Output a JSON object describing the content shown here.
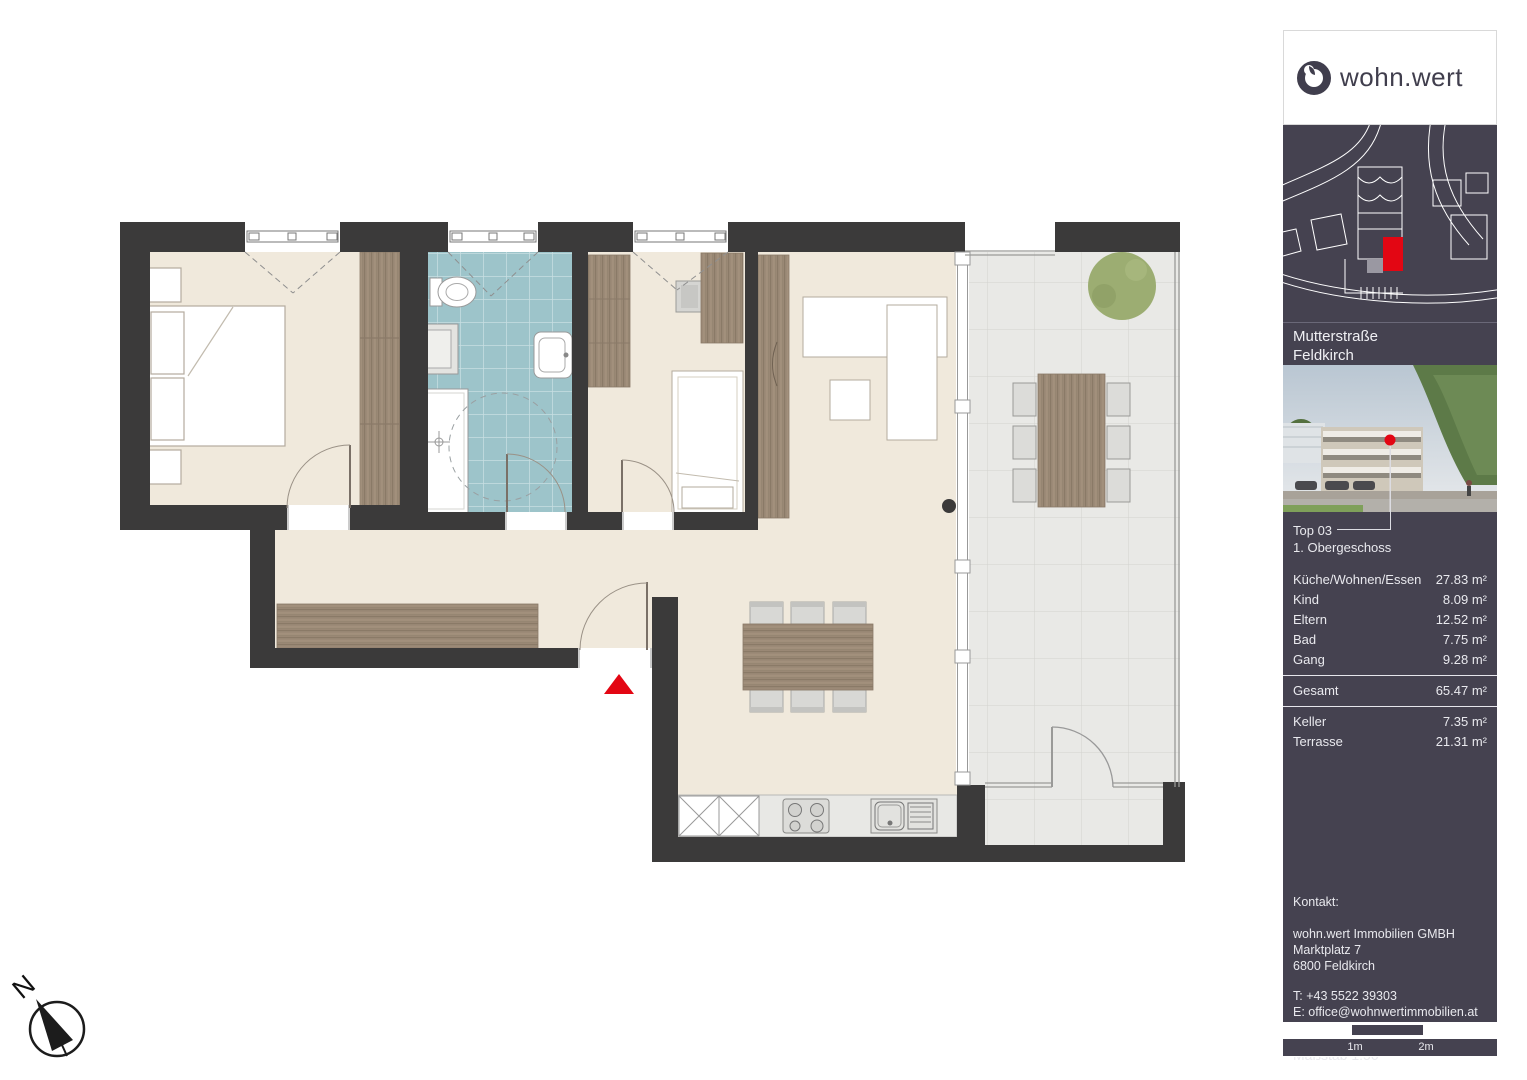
{
  "sidebar": {
    "logo_text": "wohn.wert",
    "location": {
      "line1": "Mutterstraße",
      "line2": "Feldkirch"
    },
    "unit": {
      "name": "Top 03",
      "floor": "1. Obergeschoss"
    },
    "areas": [
      {
        "label": "Küche/Wohnen/Essen",
        "value": "27.83 m²"
      },
      {
        "label": "Kind",
        "value": "8.09 m²"
      },
      {
        "label": "Eltern",
        "value": "12.52 m²"
      },
      {
        "label": "Bad",
        "value": "7.75 m²"
      },
      {
        "label": "Gang",
        "value": "9.28 m²"
      }
    ],
    "total": {
      "label": "Gesamt",
      "value": "65.47 m²"
    },
    "extras": [
      {
        "label": "Keller",
        "value": "7.35 m²"
      },
      {
        "label": "Terrasse",
        "value": "21.31 m²"
      }
    ],
    "contact": {
      "heading": "Kontakt:",
      "company": "wohn.wert Immobilien GMBH",
      "street": "Marktplatz 7",
      "city": "6800 Feldkirch",
      "phone": "T: +43 5522 39303",
      "email": "E: office@wohnwertimmobilien.at"
    },
    "scale": {
      "label": "Maßstab 1:50",
      "tick1": "1m",
      "tick2": "2m"
    }
  },
  "floorplan": {
    "labels": {
      "washing_machine": "WM",
      "compass_north": "N"
    }
  },
  "colors": {
    "wall": "#3b3a3a",
    "floor": "#f0e9dc",
    "bath_tile": "#9dc4ca",
    "terrace_tile": "#e9e9e6",
    "wood": "#9c8a77",
    "accent_red": "#e30613",
    "panel_navy": "#454250",
    "tree_green": "#9cad72"
  }
}
